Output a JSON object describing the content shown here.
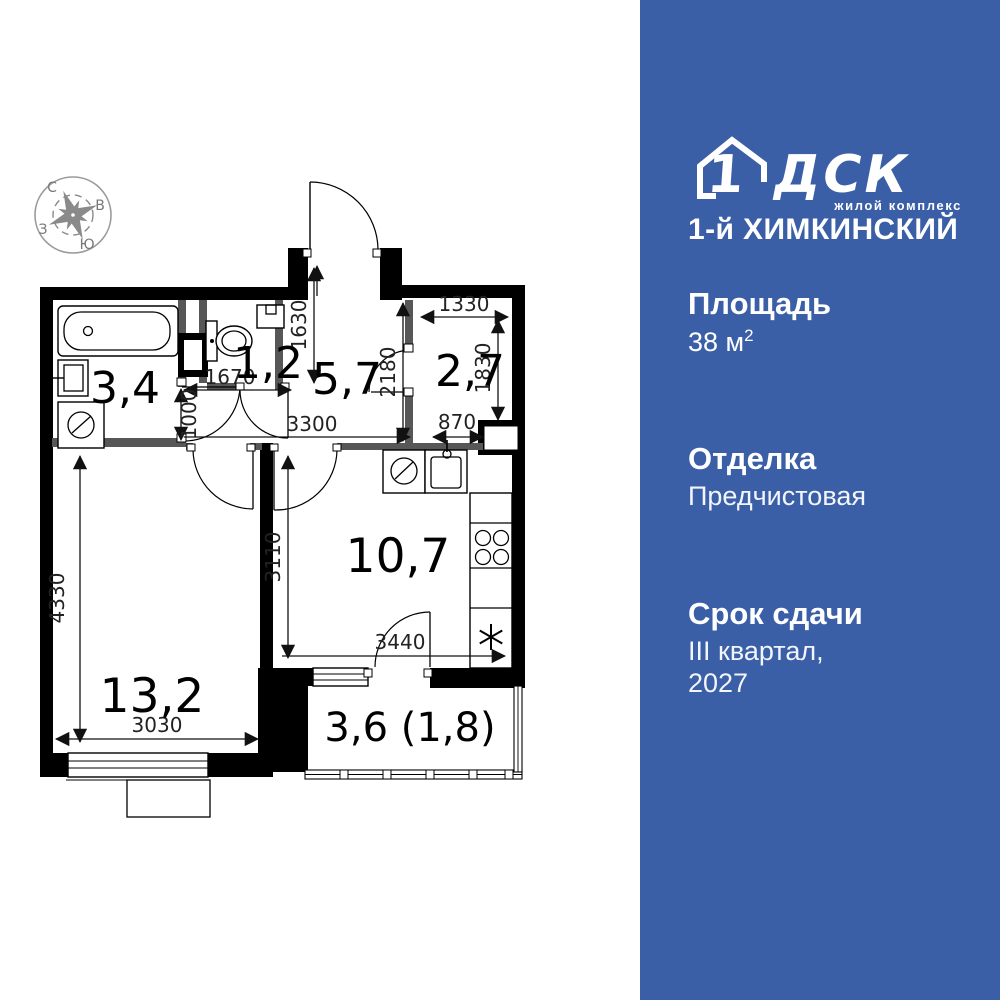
{
  "colors": {
    "panel_blue": "#3a5fa6",
    "wall_black": "#000000",
    "inner_wall_gray": "#575757",
    "compass_gray": "#8a8a8a"
  },
  "compass": {
    "north": "С",
    "east": "В",
    "south": "Ю",
    "west": "З"
  },
  "plan": {
    "rooms": {
      "bathroom": "3,4",
      "toilet": "1,2",
      "hall": "5,7",
      "storage": "2,7",
      "kitchen": "10,7",
      "living": "13,2",
      "balcony": "3,6 (1,8)"
    },
    "dims": {
      "d1630": "1630",
      "d1670": "1670",
      "d1000": "1000",
      "d3300": "3300",
      "d2180": "2180",
      "d1330": "1330",
      "d1830": "1830",
      "d870": "870",
      "d3110": "3110",
      "d3440": "3440",
      "d4330": "4330",
      "d3030": "3030"
    }
  },
  "sidebar": {
    "logo": {
      "number": "1",
      "brand": "ДСК",
      "tagline": "жилой комплекс",
      "complex": "1-й ХИМКИНСКИЙ"
    },
    "area": {
      "label": "Площадь",
      "value": "38 м",
      "sup": "2"
    },
    "finish": {
      "label": "Отделка",
      "value": "Предчистовая"
    },
    "deadline": {
      "label": "Срок сдачи",
      "line1": "III квартал,",
      "line2": "2027"
    }
  }
}
